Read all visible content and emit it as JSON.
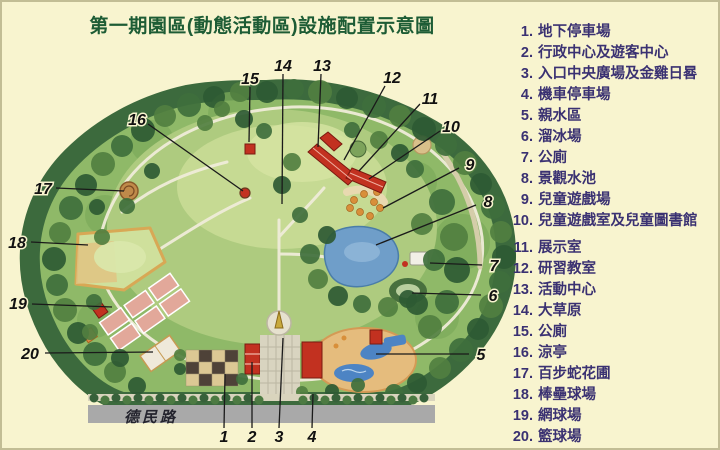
{
  "title": "第一期園區(動態活動區)設施配置示意圖",
  "map": {
    "road_label": "德民路",
    "callouts": [
      "1",
      "2",
      "3",
      "4",
      "5",
      "6",
      "7",
      "8",
      "9",
      "10",
      "11",
      "12",
      "13",
      "14",
      "15",
      "16",
      "17",
      "18",
      "19",
      "20"
    ]
  },
  "legend": {
    "items": [
      {
        "num": "1.",
        "label": "地下停車場"
      },
      {
        "num": "2.",
        "label": "行政中心及遊客中心"
      },
      {
        "num": "3.",
        "label": "入口中央廣場及金雞日晷"
      },
      {
        "num": "4.",
        "label": "機車停車場"
      },
      {
        "num": "5.",
        "label": "親水區"
      },
      {
        "num": "6.",
        "label": "溜冰場"
      },
      {
        "num": "7.",
        "label": "公廁"
      },
      {
        "num": "8.",
        "label": "景觀水池"
      },
      {
        "num": "9.",
        "label": "兒童遊戲場"
      },
      {
        "num": "10.",
        "label": "兒童遊戲室及兒童圖書館"
      },
      {
        "num": "11.",
        "label": "展示室"
      },
      {
        "num": "12.",
        "label": "研習教室"
      },
      {
        "num": "13.",
        "label": "活動中心"
      },
      {
        "num": "14.",
        "label": "大草原"
      },
      {
        "num": "15.",
        "label": "公廁"
      },
      {
        "num": "16.",
        "label": "涼亭"
      },
      {
        "num": "17.",
        "label": "百步蛇花圃"
      },
      {
        "num": "18.",
        "label": "棒壘球場"
      },
      {
        "num": "19.",
        "label": "網球場"
      },
      {
        "num": "20.",
        "label": "籃球場"
      }
    ]
  },
  "colors": {
    "background": "#f8f4cf",
    "title_text": "#1d5c35",
    "legend_text": "#3a3172",
    "road": "#a9a9a9",
    "pond_water": "#6f9ec9",
    "lawn": "#aecb7f",
    "tree": "#2e5a33",
    "building_roof": "#c23120",
    "callout_text": "#111111"
  }
}
